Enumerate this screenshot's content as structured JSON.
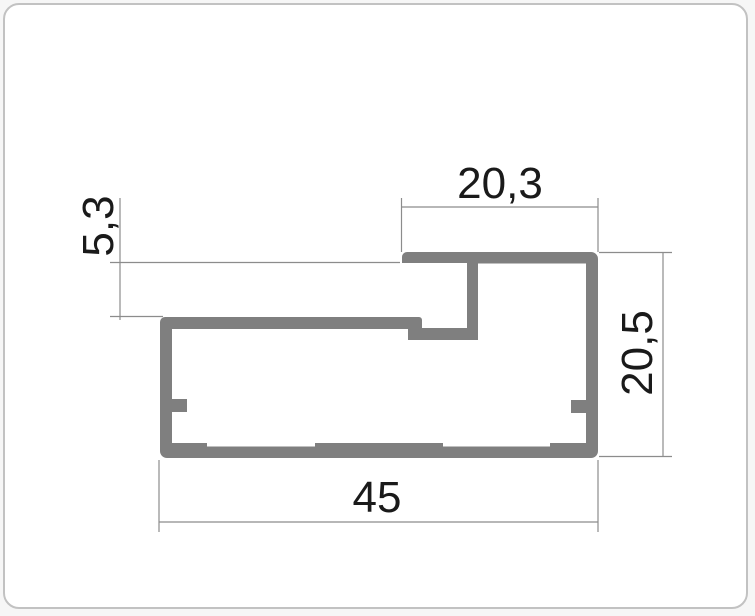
{
  "page": {
    "background_color": "#f6f6f6",
    "card_border_color": "#c2c2c2",
    "card_background_color": "#ffffff"
  },
  "drawing": {
    "description": "aluminum-profile-cross-section",
    "profile_color": "#7f7f7f",
    "line_color": "#8c8c8c",
    "text_color": "#1a1a1a",
    "dimensions": {
      "top_width": {
        "label": "20,3",
        "value": 20.3
      },
      "slot_height": {
        "label": "5,3",
        "value": 5.3
      },
      "overall_height": {
        "label": "20,5",
        "value": 20.5
      },
      "overall_width": {
        "label": "45",
        "value": 45
      }
    }
  }
}
